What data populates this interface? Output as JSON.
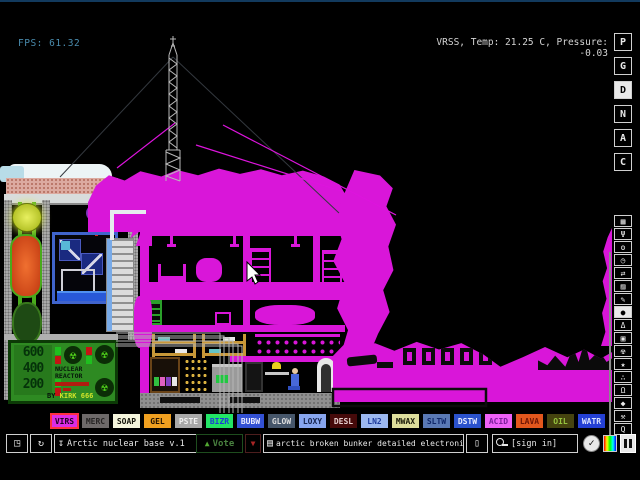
{
  "colors": {
    "virus": "#d916d9",
    "selected_border": "#ff3040"
  },
  "hud": {
    "fps": "FPS: 61.32",
    "status": "VRSS, Temp: 21.25 C, Pressure: -0.03"
  },
  "sidebar": {
    "letters": [
      {
        "name": "p",
        "label": "P"
      },
      {
        "name": "g",
        "label": "G"
      },
      {
        "name": "d",
        "label": "D",
        "active": true
      },
      {
        "name": "n",
        "label": "N"
      },
      {
        "name": "a",
        "label": "A"
      },
      {
        "name": "c",
        "label": "C"
      }
    ],
    "icons": [
      {
        "name": "console",
        "glyph": "▦"
      },
      {
        "name": "electronics-plug",
        "glyph": "Ψ"
      },
      {
        "name": "powered",
        "glyph": "ʘ"
      },
      {
        "name": "sensors-gauge",
        "glyph": "◷"
      },
      {
        "name": "force-arrows",
        "glyph": "⇄"
      },
      {
        "name": "explosives-spray",
        "glyph": "▨"
      },
      {
        "name": "tools-pencil",
        "glyph": "✎"
      },
      {
        "name": "liquids-droplet",
        "glyph": "●",
        "active": true
      },
      {
        "name": "powders-flask",
        "glyph": "Δ"
      },
      {
        "name": "solids",
        "glyph": "▣"
      },
      {
        "name": "radioactive",
        "glyph": "☢"
      },
      {
        "name": "special-star",
        "glyph": "★"
      },
      {
        "name": "life-dots",
        "glyph": "∴"
      },
      {
        "name": "gases-lamp",
        "glyph": "Ω"
      },
      {
        "name": "favorites",
        "glyph": "◆"
      },
      {
        "name": "hammer",
        "glyph": "⚒"
      },
      {
        "name": "search",
        "glyph": "Q"
      }
    ]
  },
  "palette": {
    "items": [
      {
        "name": "virs",
        "label": "VIRS",
        "bg": "#dc2ce4",
        "fg": "#200020",
        "selected": true
      },
      {
        "name": "merc",
        "label": "MERC",
        "bg": "#6e6a6a",
        "fg": "#262424"
      },
      {
        "name": "soap",
        "label": "SOAP",
        "bg": "#f5f5dc",
        "fg": "#14140a"
      },
      {
        "name": "gel",
        "label": "GEL",
        "bg": "#f0a020",
        "fg": "#201000"
      },
      {
        "name": "pste",
        "label": "PSTE",
        "bg": "#a8a8a8",
        "fg": "#f0f0f0"
      },
      {
        "name": "bizr",
        "label": "BIZR",
        "bg": "#22e566",
        "fg": "#1b3bd8"
      },
      {
        "name": "bubw",
        "label": "BUBW",
        "bg": "#3351d4",
        "fg": "#eeeeff"
      },
      {
        "name": "glow",
        "label": "GLOW",
        "bg": "#46566a",
        "fg": "#dddddd"
      },
      {
        "name": "loxy",
        "label": "LOXY",
        "bg": "#88a6ee",
        "fg": "#16244e"
      },
      {
        "name": "desl",
        "label": "DESL",
        "bg": "#460a0a",
        "fg": "#e8d0d0"
      },
      {
        "name": "ln2",
        "label": "LN2",
        "bg": "#9cb8f0",
        "fg": "#1c3a9c"
      },
      {
        "name": "mwax",
        "label": "MWAX",
        "bg": "#dede9c",
        "fg": "#1a1a08"
      },
      {
        "name": "sltw",
        "label": "SLTW",
        "bg": "#5a79b5",
        "fg": "#0f2668"
      },
      {
        "name": "dstw",
        "label": "DSTW",
        "bg": "#2b52cc",
        "fg": "#e8ecff"
      },
      {
        "name": "acid",
        "label": "ACID",
        "bg": "#ee61f7",
        "fg": "#7a1e9c"
      },
      {
        "name": "lava",
        "label": "LAVA",
        "bg": "#e2571d",
        "fg": "#6e1505"
      },
      {
        "name": "oil",
        "label": "OIL",
        "bg": "#45430f",
        "fg": "#96c43e"
      },
      {
        "name": "watr",
        "label": "WATR",
        "bg": "#2440d4",
        "fg": "#dce4ff"
      }
    ]
  },
  "bottombar": {
    "open_glyph": "◳",
    "reload_glyph": "↻",
    "save_glyph": "↧",
    "save_label": "Arctic nuclear base v.1",
    "vote_up_glyph": "▲",
    "vote_label": "Vote",
    "vote_down_glyph": "▼",
    "tag_glyph": "▤",
    "tags_label": "arctic broken bunker detailed electronic...",
    "new_glyph": "▯",
    "signin_label": "[sign in]",
    "check_glyph": "✓"
  },
  "scene": {
    "sign": {
      "r1": "600",
      "r2": "400",
      "r3": "200",
      "title": "NUCLEAR REACTOR",
      "rad_glyph": "☢",
      "by_label": "BY",
      "by_name": "KIRK 666"
    }
  }
}
